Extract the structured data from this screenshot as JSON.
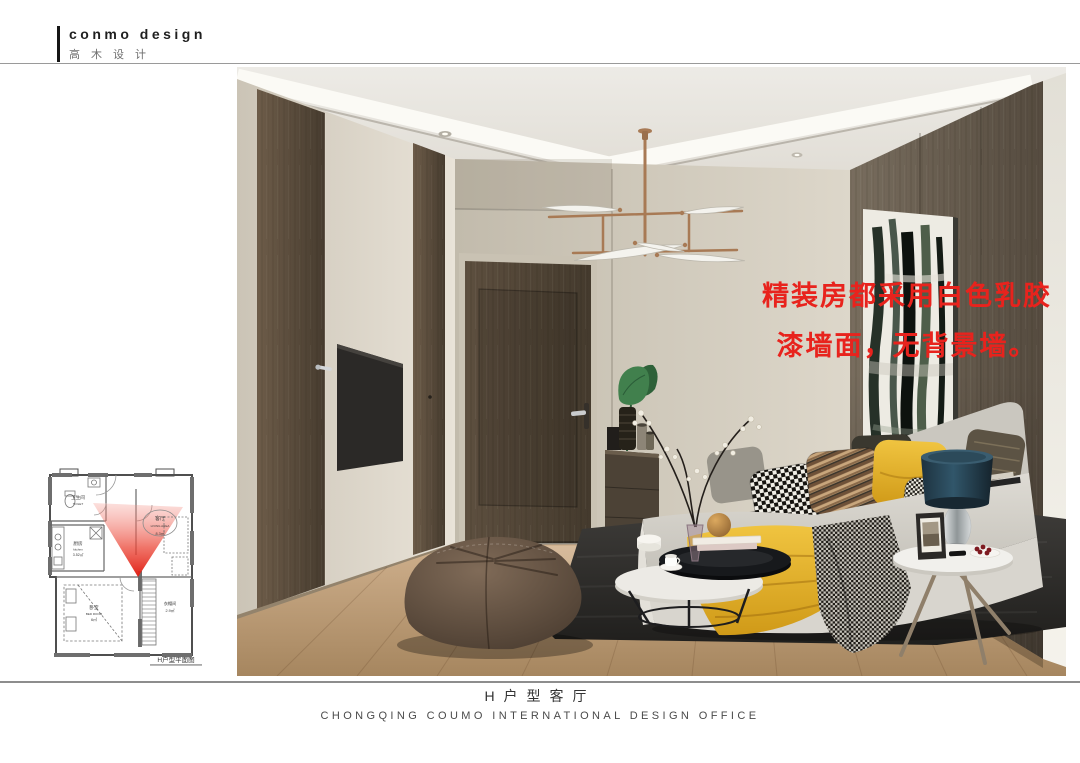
{
  "brand": {
    "name_en": "conmo design",
    "name_zh": "高木设计"
  },
  "render": {
    "description": "living room interior rendering",
    "annotation": {
      "line1": "精装房都采用白色乳胶",
      "line2": "漆墙面，无背景墙。",
      "color": "#e8231d"
    }
  },
  "floor_plan": {
    "caption": "H户型平面图",
    "rooms": [
      {
        "zh": "卫生间",
        "en": "TOILET"
      },
      {
        "zh": "厨房",
        "en": "kitchen",
        "area": "3.52㎡"
      },
      {
        "zh": "客厅",
        "en": "LIVING AREA",
        "area": "8.3㎡"
      },
      {
        "zh": "卧室",
        "en": "BED ROOM",
        "area": "6㎡"
      },
      {
        "zh": "衣帽间",
        "area": "2.9㎡"
      }
    ]
  },
  "footer": {
    "title": "H户型客厅",
    "subtitle": "CHONGQING COUMO INTERNATIONAL DESIGN OFFICE"
  },
  "palette": {
    "annotation_red": "#e8231d",
    "wood_dark": "#564939",
    "wall_cream": "#ddd6ca",
    "wall_beige": "#d3ccbe",
    "wood_right": "#6a6052",
    "floor": "#bb9a76",
    "accent_copper": "#a87a55",
    "lamp_shade": "#24424f",
    "pillow_yellow": "#e5b42c"
  }
}
